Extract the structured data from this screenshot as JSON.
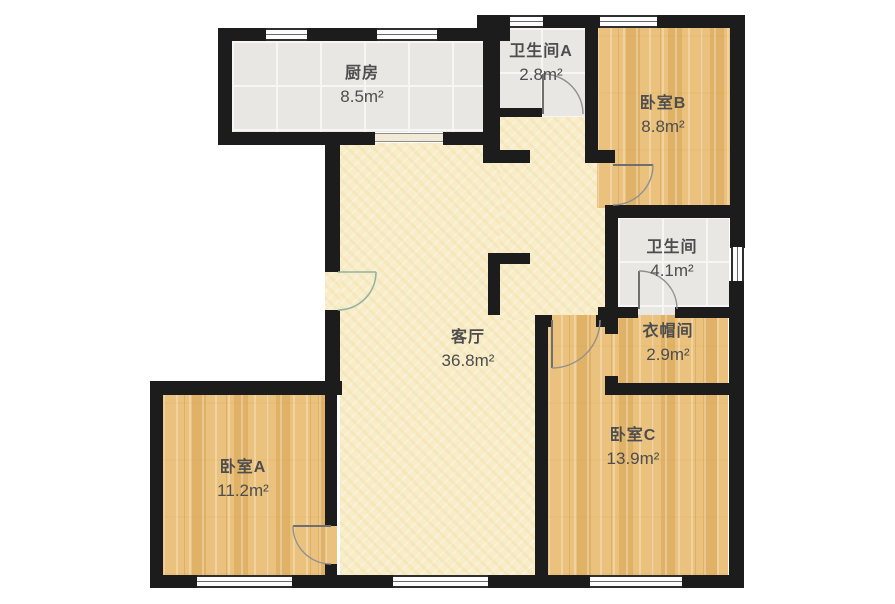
{
  "rooms": [
    {
      "id": "kitchen",
      "name": "厨房",
      "area": "8.5m²"
    },
    {
      "id": "bathroom-a",
      "name": "卫生间A",
      "area": "2.8m²"
    },
    {
      "id": "bedroom-b",
      "name": "卧室B",
      "area": "8.8m²"
    },
    {
      "id": "bathroom",
      "name": "卫生间",
      "area": "4.1m²"
    },
    {
      "id": "cloakroom",
      "name": "衣帽间",
      "area": "2.9m²"
    },
    {
      "id": "living-room",
      "name": "客厅",
      "area": "36.8m²"
    },
    {
      "id": "bedroom-a",
      "name": "卧室A",
      "area": "11.2m²"
    },
    {
      "id": "bedroom-c",
      "name": "卧室C",
      "area": "13.9m²"
    }
  ],
  "colors": {
    "wall": "#1c1c1c",
    "wood_floor": "#ebc27d",
    "tile_floor": "#e9e7e3",
    "living_floor": "#f8edc9",
    "label_text": "#4d4d4d",
    "entry_door_accent": "#8fb3a3"
  }
}
